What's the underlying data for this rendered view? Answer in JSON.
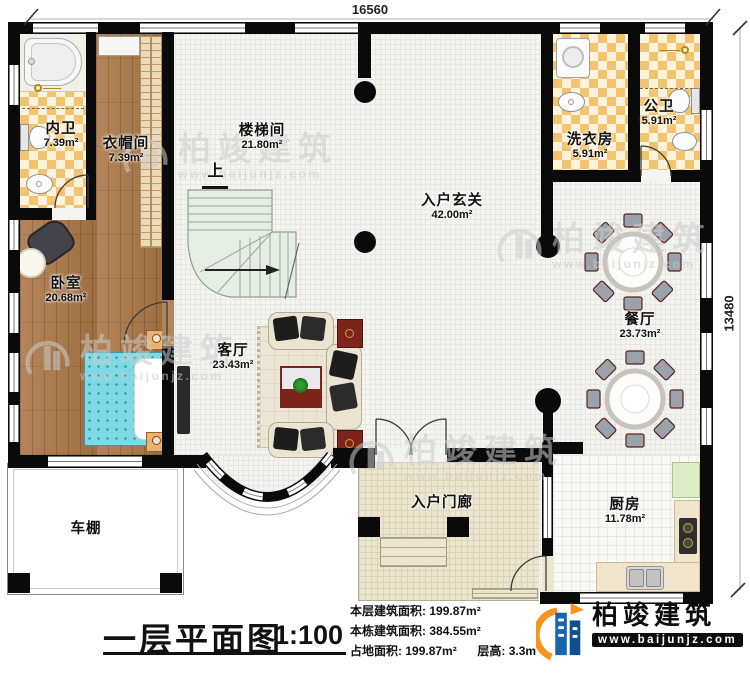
{
  "dimensions": {
    "top": "16560",
    "right": "13480"
  },
  "rooms": [
    {
      "id": "bath-private",
      "name": "内卫",
      "area": "7.39m²"
    },
    {
      "id": "cloakroom",
      "name": "衣帽间",
      "area": "7.39m²"
    },
    {
      "id": "stairwell",
      "name": "楼梯间",
      "area": "21.80m²"
    },
    {
      "id": "bath-public",
      "name": "公卫",
      "area": "5.91m²"
    },
    {
      "id": "laundry",
      "name": "洗衣房",
      "area": "5.91m²"
    },
    {
      "id": "entry-foyer",
      "name": "入户玄关",
      "area": "42.00m²"
    },
    {
      "id": "bedroom",
      "name": "卧室",
      "area": "20.68m²"
    },
    {
      "id": "dining",
      "name": "餐厅",
      "area": "23.73m²"
    },
    {
      "id": "living",
      "name": "客厅",
      "area": "23.43m²"
    },
    {
      "id": "kitchen",
      "name": "厨房",
      "area": "11.78m²"
    },
    {
      "id": "entry-porch",
      "name": "入户门廊"
    },
    {
      "id": "carport",
      "name": "车棚"
    }
  ],
  "stair": {
    "up_label": "上"
  },
  "title_block": {
    "plan_title": "一层平面图",
    "scale": "1:100",
    "stats": [
      {
        "label": "本层建筑面积:",
        "value": "199.87m²"
      },
      {
        "label": "本栋建筑面积:",
        "value": "384.55m²"
      },
      {
        "label": "占地面积:",
        "value": "199.87m²"
      },
      {
        "label": "层高:",
        "value": "3.3m"
      }
    ]
  },
  "branding": {
    "company": "柏竣建筑",
    "website": "www.baijunjz.com"
  },
  "watermark": {
    "text": "柏竣建筑",
    "subtext": "www.baijunjz.com"
  },
  "colors": {
    "wall": "#0a0a0a",
    "checker_tile": "#f3c46f",
    "wood_floor": "#aa7a48",
    "stair": "#e5ede4",
    "bed": "#7fd9e4",
    "logo_blue": "#1765ad",
    "logo_orange": "#f7941e"
  }
}
